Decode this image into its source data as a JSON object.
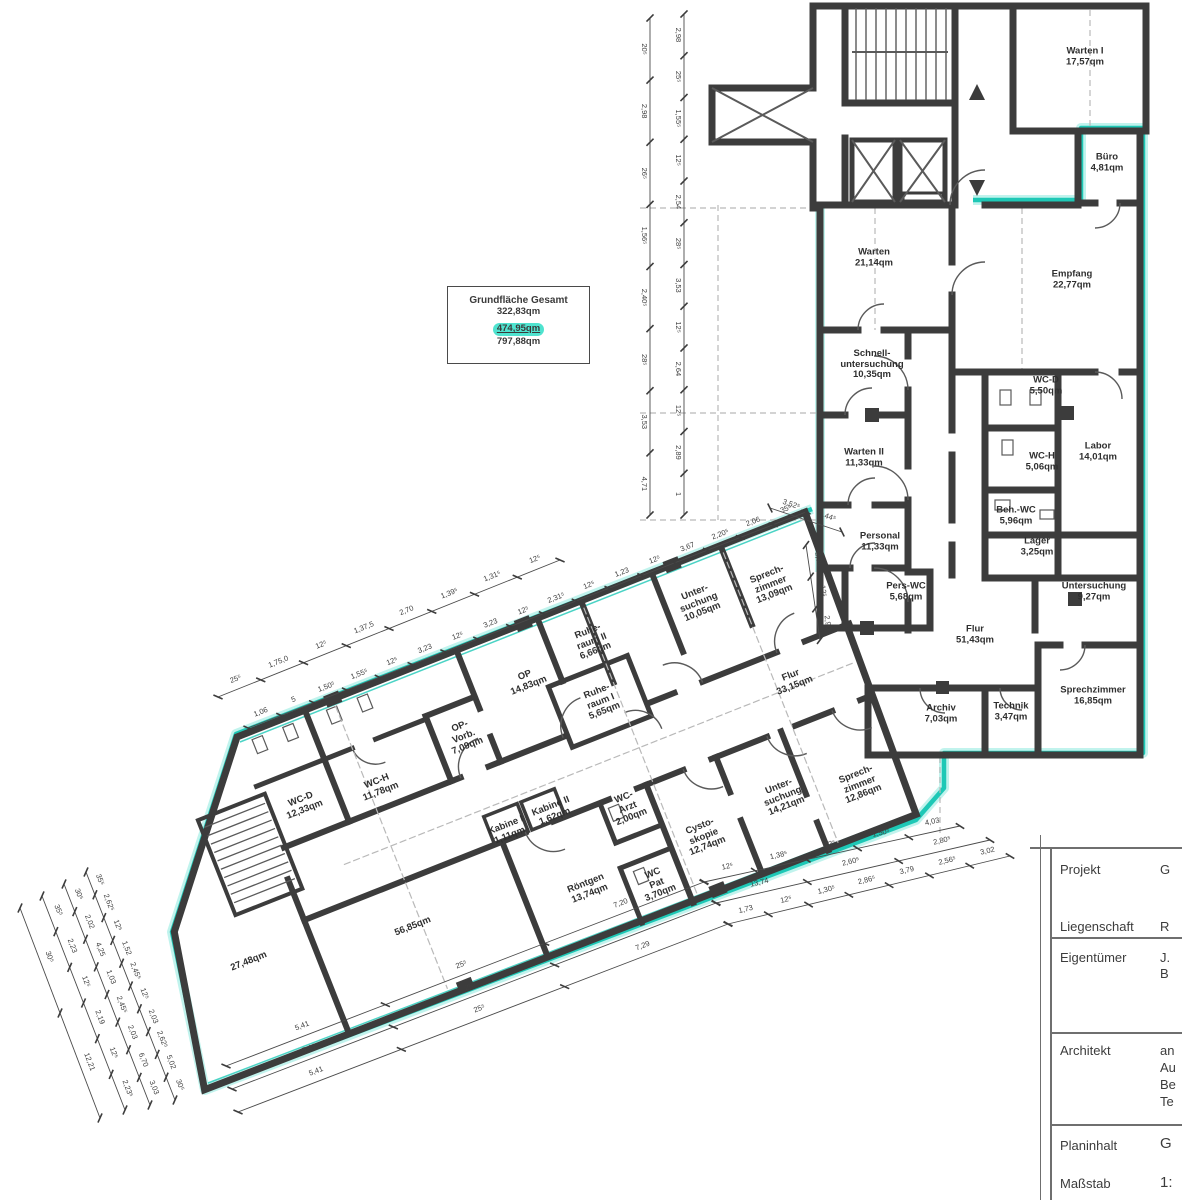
{
  "meta": {
    "width": 1182,
    "height": 1200,
    "drawing_type": "architectural floor plan"
  },
  "colors": {
    "wall": "#3c3c3c",
    "highlight": "#1ec8b6",
    "highlight_glow": "#8eeadf",
    "dim": "#4a4a4a",
    "dashed": "#b9b9b9",
    "text": "#2f2f2f"
  },
  "grundflaeche": {
    "title": "Grundfläche Gesamt",
    "v1": "322,83qm",
    "v2": "474,95qm",
    "v3": "797,88qm"
  },
  "rooms_upper": [
    {
      "name": "Warten I",
      "area": "17,57qm",
      "x": 1085,
      "y": 57
    },
    {
      "name": "Büro",
      "area": "4,81qm",
      "x": 1107,
      "y": 163
    },
    {
      "name": "Warten",
      "area": "21,14qm",
      "x": 874,
      "y": 258
    },
    {
      "name": "Empfang",
      "area": "22,77qm",
      "x": 1072,
      "y": 280
    },
    {
      "name": "Schnell-",
      "name2": "untersuchung",
      "area": "10,35qm",
      "x": 872,
      "y": 365
    },
    {
      "name": "WC-D",
      "area": "5,50qm",
      "x": 1046,
      "y": 386
    },
    {
      "name": "Warten II",
      "area": "11,33qm",
      "x": 864,
      "y": 458
    },
    {
      "name": "WC-H",
      "area": "5,06qm",
      "x": 1042,
      "y": 462
    },
    {
      "name": "Labor",
      "area": "14,01qm",
      "x": 1098,
      "y": 452
    },
    {
      "name": "Beh.-WC",
      "area": "5,96qm",
      "x": 1016,
      "y": 516
    },
    {
      "name": "Personal",
      "area": "11,33qm",
      "x": 880,
      "y": 542
    },
    {
      "name": "Lager",
      "area": "3,25qm",
      "x": 1037,
      "y": 547
    },
    {
      "name": "Pers-WC",
      "area": "5,68qm",
      "x": 906,
      "y": 592
    },
    {
      "name": "Untersuchung",
      "area": "9,27qm",
      "x": 1094,
      "y": 592
    },
    {
      "name": "Flur",
      "area": "51,43qm",
      "x": 975,
      "y": 635
    },
    {
      "name": "Archiv",
      "area": "7,03qm",
      "x": 941,
      "y": 714
    },
    {
      "name": "Technik",
      "area": "3,47qm",
      "x": 1011,
      "y": 712
    },
    {
      "name": "Sprechzimmer",
      "area": "16,85qm",
      "x": 1093,
      "y": 696
    }
  ],
  "rooms_wing": [
    {
      "name": "Sprech-",
      "name2": "zimmer",
      "area": "13,09qm",
      "x": 771,
      "y": 585
    },
    {
      "name": "Unter-",
      "name2": "suchung",
      "area": "10,05qm",
      "x": 699,
      "y": 603
    },
    {
      "name": "Ruhe-",
      "name2": "raum II",
      "area": "6,66qm",
      "x": 592,
      "y": 642
    },
    {
      "name": "OP",
      "area": "14,83qm",
      "x": 527,
      "y": 681
    },
    {
      "name": "Ruhe-",
      "name2": "raum I",
      "area": "5,65qm",
      "x": 601,
      "y": 702
    },
    {
      "name": "OP-",
      "name2": "Vorb.",
      "area": "7,09qm",
      "x": 464,
      "y": 737
    },
    {
      "name": "WC-H",
      "area": "11,78qm",
      "x": 379,
      "y": 787
    },
    {
      "name": "WC-D",
      "area": "12,33qm",
      "x": 303,
      "y": 805
    },
    {
      "name": "Kabine I",
      "area": "1,11qm",
      "x": 508,
      "y": 831
    },
    {
      "name": "Kabine II",
      "area": "1,62qm",
      "x": 553,
      "y": 812
    },
    {
      "name": "WC-",
      "name2": "Arzt",
      "area": "2,00qm",
      "x": 628,
      "y": 808
    },
    {
      "name": "Cysto-",
      "name2": "skopie",
      "area": "12,74qm",
      "x": 704,
      "y": 837
    },
    {
      "name": "WC",
      "name2": "Pat",
      "area": "3,70qm",
      "x": 657,
      "y": 884
    },
    {
      "name": "Röntgen",
      "area": "13,74qm",
      "x": 588,
      "y": 889
    },
    {
      "name": "Unter-",
      "name2": "suchung",
      "area": "14,21qm",
      "x": 783,
      "y": 797
    },
    {
      "name": "Sprech-",
      "name2": "zimmer",
      "area": "12,86qm",
      "x": 860,
      "y": 785
    },
    {
      "name": "Flur",
      "area": "33,15qm",
      "x": 793,
      "y": 681
    },
    {
      "name": "",
      "area": "56,85qm",
      "x": 413,
      "y": 927
    },
    {
      "name": "",
      "area": "27,48qm",
      "x": 249,
      "y": 962
    }
  ],
  "dimensions": {
    "chains": [
      {
        "x1": 650,
        "y1": 18,
        "x2": 650,
        "y2": 515,
        "labels": [
          "20⁵",
          "2,98",
          "26⁵",
          "1,56⁵",
          "2,40⁵",
          "28⁵",
          "3,53",
          "4,71"
        ]
      },
      {
        "x1": 684,
        "y1": 14,
        "x2": 684,
        "y2": 515,
        "labels": [
          "2,98",
          "25⁵",
          "1,55⁵",
          "12⁵",
          "2,54",
          "28⁵",
          "3,53",
          "12⁵",
          "2,64",
          "12⁵",
          "2,89",
          "1"
        ]
      },
      {
        "x1": 218,
        "y1": 697,
        "x2": 560,
        "y2": 560,
        "labels": [
          "25⁵",
          "1,75,0",
          "12⁵",
          "1,37,5",
          "2,70",
          "1,39⁵",
          "1,31⁵",
          "12⁵"
        ]
      },
      {
        "x1": 248,
        "y1": 728,
        "x2": 806,
        "y2": 512,
        "labels": [
          "1,06",
          "5",
          "1,50⁵",
          "1,55⁵",
          "12⁵",
          "3,23",
          "12⁵",
          "3,23",
          "12⁵",
          "2,31⁵",
          "12⁵",
          "1,23",
          "12⁵",
          "3,67",
          "2,20⁵",
          "2,06",
          "35⁵"
        ]
      },
      {
        "x1": 770,
        "y1": 508,
        "x2": 842,
        "y2": 532,
        "labels": [
          "3,52⁵",
          "5,44⁵"
        ]
      },
      {
        "x1": 806,
        "y1": 545,
        "x2": 820,
        "y2": 640,
        "labels": [
          "2,86",
          "12⁵",
          "2,90"
        ]
      },
      {
        "x1": 226,
        "y1": 1066,
        "x2": 704,
        "y2": 882,
        "labels": [
          "5,41",
          "25⁵",
          "7,20"
        ]
      },
      {
        "x1": 232,
        "y1": 1089,
        "x2": 716,
        "y2": 903,
        "labels": [
          "5,41",
          "25⁵",
          "7,29"
        ]
      },
      {
        "x1": 238,
        "y1": 1112,
        "x2": 728,
        "y2": 924,
        "labels": [
          "5,41",
          "25⁵",
          "7,29"
        ]
      },
      {
        "x1": 704,
        "y1": 882,
        "x2": 960,
        "y2": 826,
        "labels": [
          "12⁵",
          "1,38⁵",
          "12⁵",
          "1,50⁵",
          "4,03"
        ]
      },
      {
        "x1": 716,
        "y1": 903,
        "x2": 990,
        "y2": 840,
        "labels": [
          "13,74",
          "2,60⁵",
          "2,80⁵"
        ]
      },
      {
        "x1": 728,
        "y1": 924,
        "x2": 1010,
        "y2": 856,
        "labels": [
          "1,73",
          "12⁵",
          "1,30⁵",
          "2,86⁵",
          "3,79",
          "2,56⁵",
          "3,02"
        ]
      },
      {
        "x1": 20,
        "y1": 908,
        "x2": 100,
        "y2": 1118,
        "labels": [
          "30⁵",
          "12,21"
        ]
      },
      {
        "x1": 42,
        "y1": 896,
        "x2": 125,
        "y2": 1110,
        "labels": [
          "35⁵",
          "2,23",
          "12⁵",
          "2,19",
          "12⁵",
          "2,23⁵"
        ]
      },
      {
        "x1": 64,
        "y1": 884,
        "x2": 150,
        "y2": 1105,
        "labels": [
          "30⁵",
          "2,02",
          "4,25",
          "1,03",
          "2,45⁵",
          "2,03",
          "6,70",
          "3,03"
        ]
      },
      {
        "x1": 86,
        "y1": 872,
        "x2": 175,
        "y2": 1100,
        "labels": [
          "35⁵",
          "2,62⁵",
          "12⁵",
          "1,52",
          "2,45⁵",
          "12⁵",
          "2,03",
          "2,62⁵",
          "5,02",
          "30⁵"
        ]
      }
    ]
  },
  "title_block": {
    "rows": [
      {
        "label": "Projekt",
        "value": "G"
      },
      {
        "label": "Liegenschaft",
        "value": "R"
      },
      {
        "label": "Eigentümer",
        "value": "J.",
        "value2": "B"
      },
      {
        "label": "Architekt",
        "value": "an",
        "value2": "Au",
        "value3": "Be",
        "value4": "Te"
      },
      {
        "label": "Planinhalt",
        "value": "G"
      },
      {
        "label": "Maßstab",
        "value": "1:"
      }
    ]
  }
}
